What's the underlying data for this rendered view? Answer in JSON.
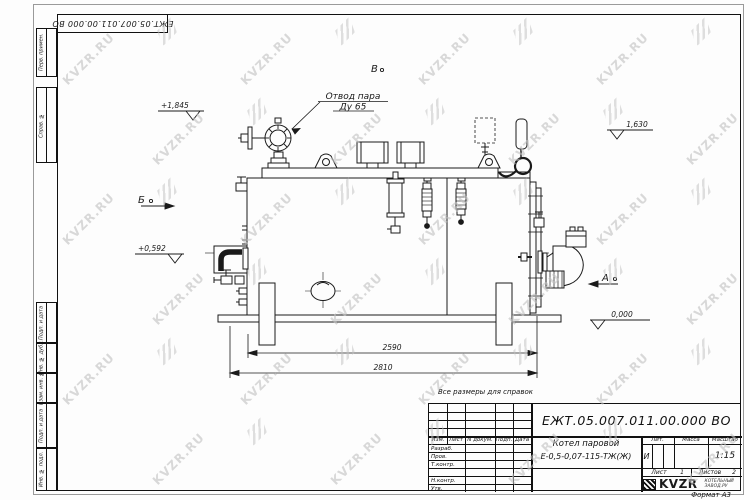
{
  "page": {
    "watermark_text": "KVZR.RU",
    "format_label": "Формат А3",
    "note": "Все размеры для справок"
  },
  "corner_stamp": {
    "doc_number": "ЕЖТ.05.007.011.00.000  ВО"
  },
  "margin_column": {
    "labels": [
      "Перв. примен.",
      "Справ. №",
      "Подп. и дата",
      "Инв. № дубл.",
      "Взам. инв. №",
      "Подп. и дата",
      "Инв. № подл."
    ]
  },
  "drawing": {
    "callout_line1": "Отвод пара",
    "callout_line2": "Ду 65",
    "view_top": "В",
    "view_left": "Б",
    "view_right": "А",
    "elev_top": "+1,845",
    "elev_right_upper": "1,630",
    "elev_left": "+0,592",
    "elev_zero": "0,000",
    "dim_inner": "2590",
    "dim_overall": "2810"
  },
  "title_block": {
    "doc_number": "ЕЖТ.05.007.011.00.000  ВО",
    "name_line1": "Котел паровой",
    "name_line2": "Е-0,5-0,07-115-ТЖ(Ж)",
    "col_izm": "Изм.",
    "col_list": "Лист",
    "col_ndoc": "N докум.",
    "col_podp": "Подп.",
    "col_data": "Дата",
    "row_razrab": "Разраб.",
    "row_prov": "Пров.",
    "row_tkontr": "Т.контр.",
    "row_nkontr": "Н.контр.",
    "row_utv": "Утв.",
    "lit_label": "Лит.",
    "mass_label": "Масса",
    "scale_label": "Масштаб",
    "lit_value": "И",
    "scale_value": "1:15",
    "sheet_label": "Лист",
    "sheet_value": "1",
    "sheets_label": "Листов",
    "sheets_value": "2",
    "logo_text": "KVZR",
    "logo_sub1": "КОТЕЛЬНЫЙ",
    "logo_sub2": "ЗАВОД.РУ"
  }
}
